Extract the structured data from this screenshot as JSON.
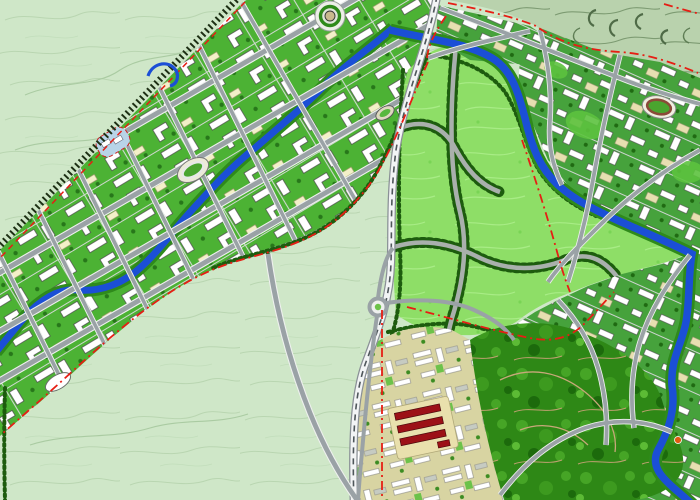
{
  "canvas": {
    "width": 700,
    "height": 500
  },
  "map": {
    "kind": "urban-master-plan",
    "colors": {
      "bg": "#cfe7c8",
      "contour_light": "#b7d4ae",
      "hills": "#b9d2ad",
      "hills_contour": "#7d9b72",
      "corridor_green": "#4cb234",
      "urban_green": "#46a23c",
      "road_fill": "#9aa2a6",
      "road_casing": "#eef0ee",
      "river": "#1b4fd6",
      "river_bank": "#2f8a1b",
      "park": "#8ede67",
      "forest": "#2e8816",
      "residential_tan": "#d8d4a2",
      "beige_block": "#e9e0ad",
      "red_building": "#9c1117",
      "boundary_red": "#e61e14",
      "railway_ties": "#1d2f14",
      "railway_white": "#f2f4f5",
      "railway_edge": "#8a9096",
      "railway_center": "#4e565a",
      "tree_row": "#1d5c0e",
      "plaza_tan": "#c9b98e",
      "pond": "#b8d4e8",
      "stadium_field": "#4aa52f",
      "track_red": "#8a4a38",
      "orange_marker": "#e05a10",
      "yellow_accent": "#f3f0c8",
      "forest_trail": "#c8a87a"
    },
    "landmarks": [
      "circular-plaza",
      "athletics-stadium",
      "sports-field",
      "right-stadium",
      "pond",
      "roundabout",
      "red-building-rows",
      "orange-marker",
      "oval-building"
    ],
    "linework": [
      "nw-railway-ties",
      "curved-railway",
      "corridor-river",
      "right-river",
      "red-planning-boundary",
      "tree-lined-roads",
      "bypass-road"
    ],
    "regions": [
      "hillside-open-land",
      "corridor-new-town",
      "central-park",
      "right-urban-district",
      "forest-park",
      "residential-south"
    ]
  }
}
